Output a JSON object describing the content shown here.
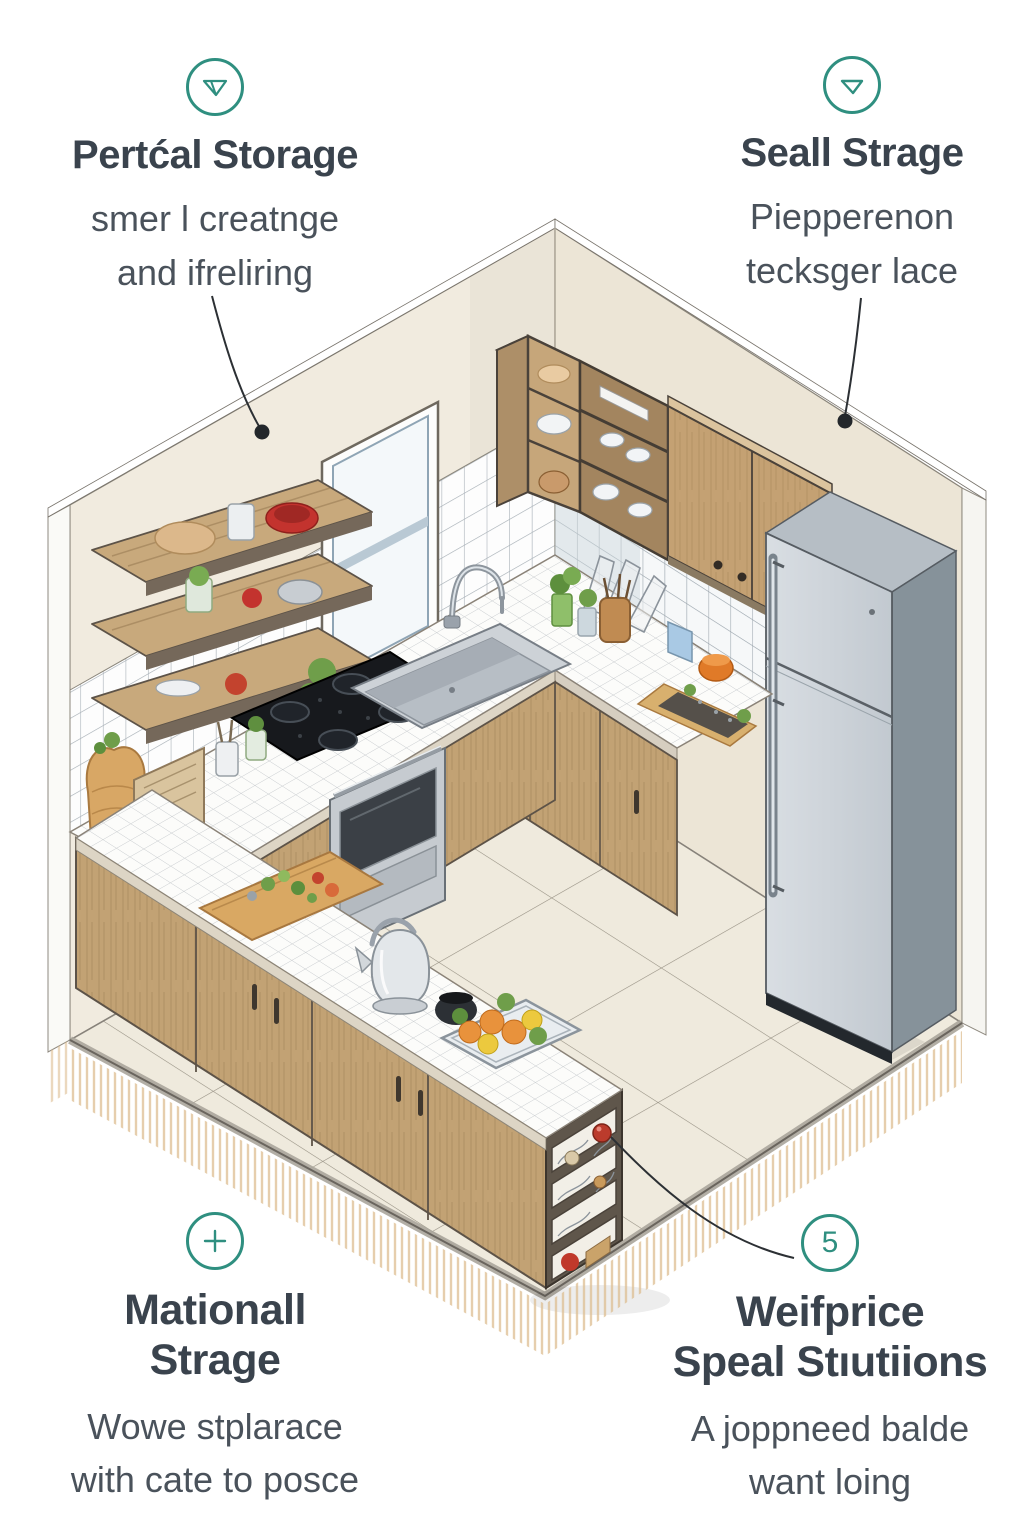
{
  "annotations": {
    "top_left": {
      "icon": "funnel-down-icon",
      "title_lines": [
        "Pertćal Storage"
      ],
      "subtitle_lines": [
        "smer l creatnge",
        "and ifreliring"
      ]
    },
    "top_right": {
      "icon": "triangle-down-icon",
      "title_lines": [
        "Seall Strage"
      ],
      "subtitle_lines": [
        "Piepperenon",
        "tecksger lace"
      ]
    },
    "bottom_left": {
      "icon": "plus-icon",
      "title_lines": [
        "Mationall",
        "Strage"
      ],
      "subtitle_lines": [
        "Wowe stplarace",
        "with cate to posce"
      ]
    },
    "bottom_right": {
      "icon": "number-badge",
      "badge_number": "5",
      "title_lines": [
        "Weifprice",
        "Speal Stıutiions"
      ],
      "subtitle_lines": [
        "A joppneed balde",
        "want loing"
      ]
    }
  },
  "colors": {
    "accent_teal": "#2f8f80",
    "title_text": "#3a434d",
    "subtitle_text": "#4a525b",
    "wall": "#f1ebdf",
    "wood_cabinet": "#c2a274",
    "fridge_front": "#ccd2d8",
    "floor": "#efeadd",
    "leader_dot": "#23272b",
    "red_marker": "#bb3b2c"
  },
  "scene": {
    "type": "isometric-kitchen-illustration",
    "elements": [
      "floating-shelves",
      "corner-shelf-unit",
      "dish-shelves",
      "upper-cabinets",
      "window",
      "sink",
      "faucet",
      "cooktop",
      "oven",
      "refrigerator",
      "base-cabinets",
      "peninsula-island",
      "open-end-shelf",
      "cutting-boards",
      "kettle",
      "fruit-tray",
      "herb-pots",
      "tile-backsplash",
      "tile-floor",
      "leader-lines",
      "marker-dots"
    ]
  }
}
